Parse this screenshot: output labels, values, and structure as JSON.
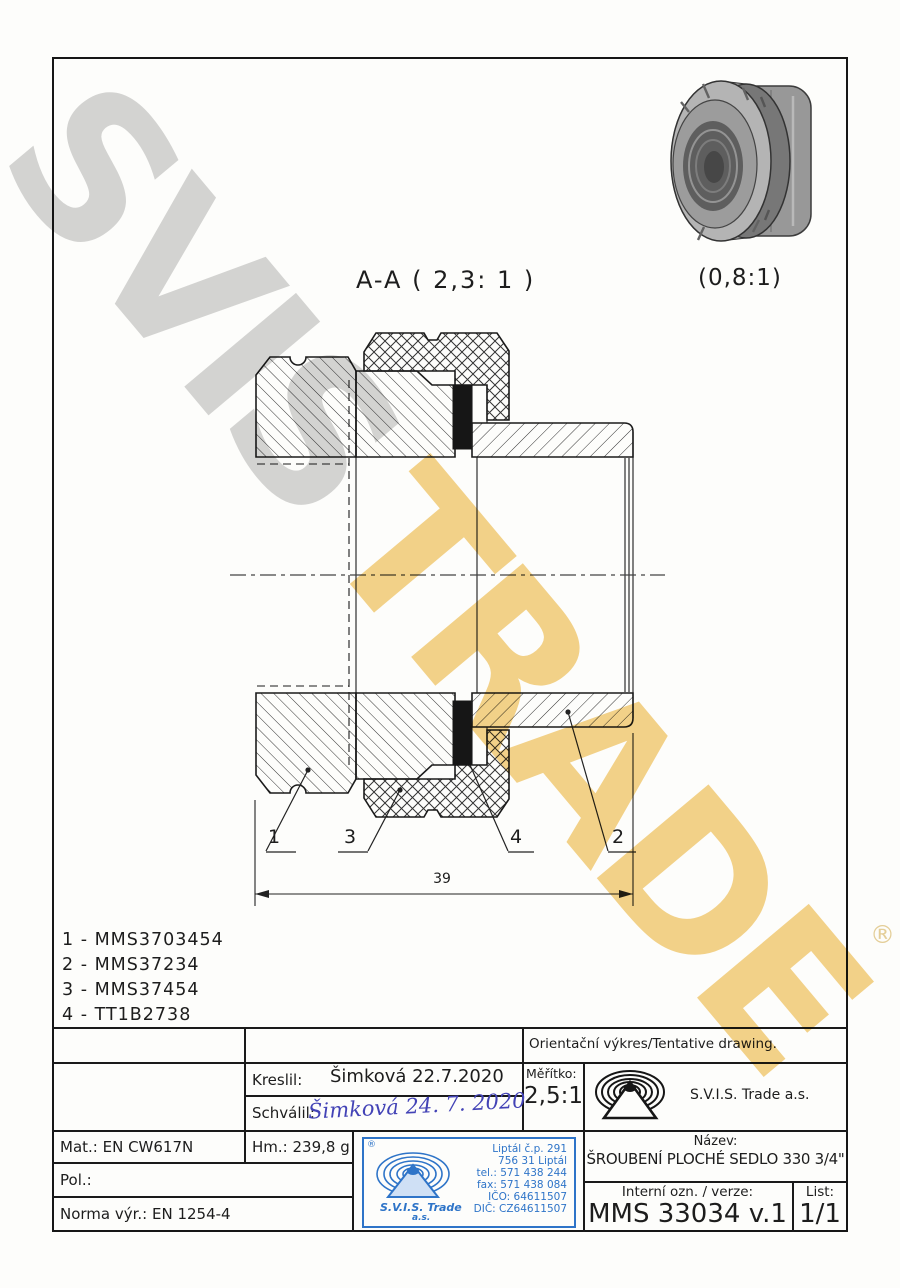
{
  "watermark": {
    "word_gray": "SVIS",
    "word_gold": "TRADE",
    "registered": "®"
  },
  "colors": {
    "stamp_blue": "#2e74c8",
    "signature_ink": "#4343b6",
    "watermark_gray": "#cbcbcb",
    "watermark_gold": "#f2c86d"
  },
  "drawing": {
    "section_view_label": "A-A ( 2,3: 1 )",
    "pictorial_scale_label": "(0,8:1)",
    "dimension_length": "39",
    "callouts": [
      "1",
      "3",
      "4",
      "2"
    ]
  },
  "parts_list": {
    "items": [
      "1 - MMS3703454",
      "2 - MMS37234",
      "3 - MMS37454",
      "4 - TT1B2738"
    ]
  },
  "title_block": {
    "orientation_note": "Orientační výkres/Tentative drawing.",
    "kreslil_label": "Kreslil:",
    "kreslil_value": "Šimková 22.7.2020",
    "schvalil_label": "Schválil:",
    "schvalil_value": "Šimková 24. 7. 2020",
    "meritko_label": "Měřítko:",
    "meritko_value": "2,5:1",
    "company_name": "S.V.I.S. Trade a.s.",
    "mat": "Mat.: EN CW617N",
    "hm": "Hm.: 239,8 g",
    "pol": "Pol.:",
    "norma": "Norma výr.: EN 1254-4",
    "nazev_label": "Název:",
    "nazev_value": "ŠROUBENÍ PLOCHÉ SEDLO 330 3/4\"",
    "interni_label": "Interní ozn. / verze:",
    "interni_value": "MMS 33034 v.1",
    "list_label": "List:",
    "list_value": "1/1"
  },
  "stamp": {
    "registered": "®",
    "lines": [
      "Liptál č.p. 291",
      "756 31 Liptál",
      "tel.: 571 438 244",
      "fax: 571 438 084",
      "IČO: 64611507",
      "DIČ: CZ64611507"
    ],
    "company": "S.V.I.S. Trade",
    "suffix": "a.s."
  }
}
